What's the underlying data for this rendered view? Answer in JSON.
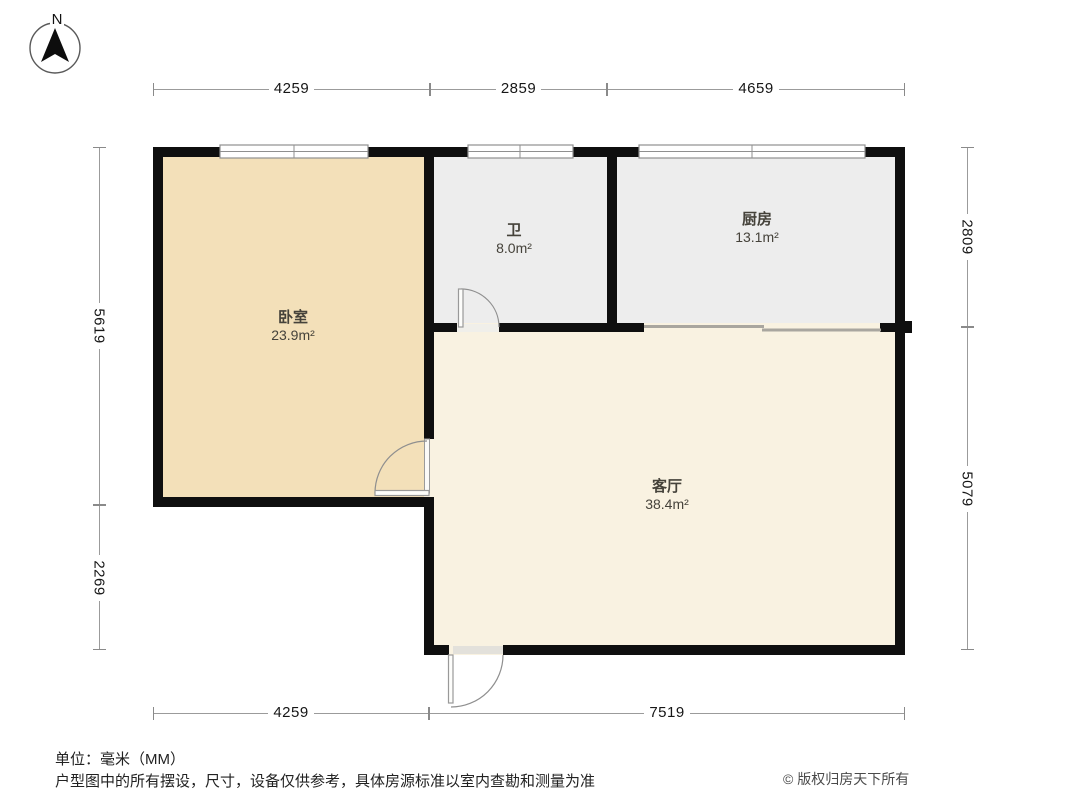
{
  "compass": {
    "label": "N"
  },
  "dims": {
    "top": [
      "4259",
      "2859",
      "4659"
    ],
    "bottom": [
      "4259",
      "7519"
    ],
    "left": [
      "5619",
      "2269"
    ],
    "right": [
      "2809",
      "5079"
    ]
  },
  "rooms": {
    "bedroom": {
      "name": "卧室",
      "area": "23.9",
      "unit": "m²"
    },
    "bath": {
      "name": "卫",
      "area": "8.0",
      "unit": "m²"
    },
    "kitchen": {
      "name": "厨房",
      "area": "13.1",
      "unit": "m²"
    },
    "living": {
      "name": "客厅",
      "area": "38.4",
      "unit": "m²"
    }
  },
  "footer": {
    "unit_note": "单位：毫米（MM）",
    "disclaimer": "户型图中的所有摆设，尺寸，设备仅供参考，具体房源标准以室内查勘和测量为准",
    "copyright": "© 版权归房天下所有"
  },
  "colors": {
    "bedroom_fill": "#F3E0B9",
    "bath_fill": "#EDEDED",
    "kitchen_fill": "#EDEDED",
    "living_fill": "#F9F2E1",
    "wall": "#0F0F0F",
    "dimension_line": "#9B9B9B"
  }
}
